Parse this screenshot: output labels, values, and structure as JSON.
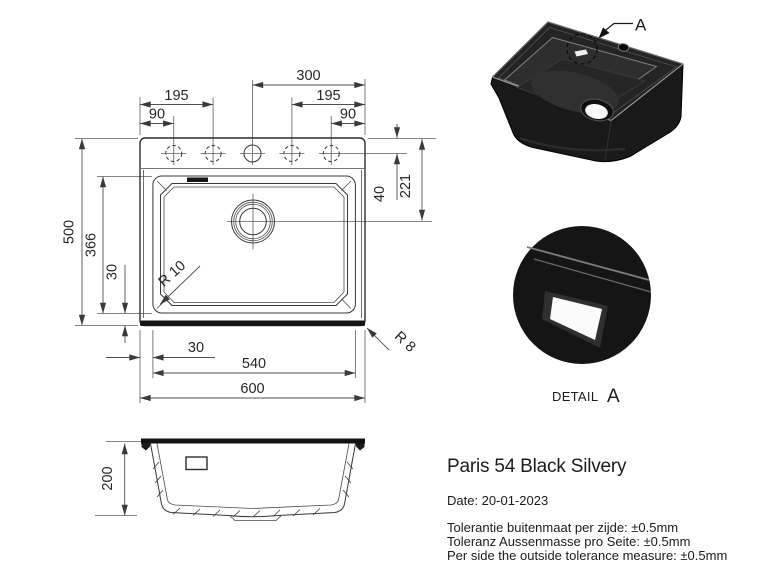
{
  "product": {
    "name": "Paris 54 Black Silvery",
    "date_line": "Date: 20-01-2023",
    "tolerances": [
      "Tolerantie buitenmaat per zijde: ±0.5mm",
      "Toleranz Aussenmasse pro Seite: ±0.5mm",
      "Per side the outside tolerance measure: ±0.5mm"
    ]
  },
  "top_view": {
    "dim_300": "300",
    "dim_195_left": "195",
    "dim_195_right": "195",
    "dim_90_left": "90",
    "dim_90_right": "90",
    "dim_40": "40",
    "dim_221": "221",
    "dim_500": "500",
    "dim_366": "366",
    "dim_30_left": "30",
    "dim_30_bottom": "30",
    "dim_540": "540",
    "dim_600": "600",
    "radius_bowl": "R 10",
    "radius_outer": "R 8"
  },
  "side_view": {
    "dim_200": "200"
  },
  "iso_view": {
    "detail_marker": "A"
  },
  "detail_view": {
    "caption": "DETAIL",
    "letter": "A"
  },
  "colors": {
    "background": "#ffffff",
    "dimension_line": "#4f4f4f",
    "object_line": "#2d2d2d",
    "sink_black": "#1a1a1a",
    "text": "#1c1c1c"
  }
}
